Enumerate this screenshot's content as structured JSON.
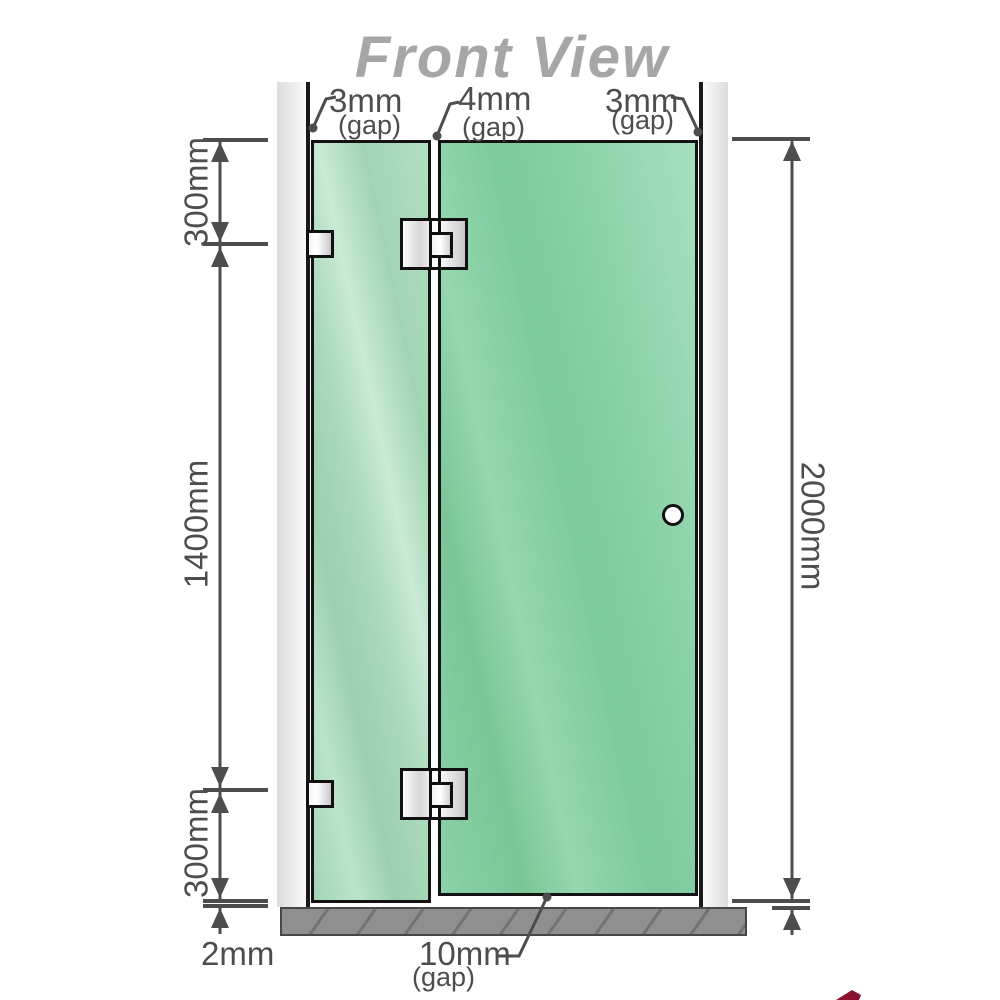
{
  "title": "Front View",
  "labels": {
    "gaps": {
      "left": {
        "value": "3mm",
        "note": "(gap)"
      },
      "middle": {
        "value": "4mm",
        "note": "(gap)"
      },
      "right": {
        "value": "3mm",
        "note": "(gap)"
      },
      "bottom": {
        "value": "10mm",
        "note": "(gap)"
      }
    },
    "dims": {
      "left_top": "300mm",
      "left_middle": "1400mm",
      "left_bottom": "300mm",
      "right_height": "2000mm",
      "floor_clearance": "2mm"
    }
  },
  "components": {
    "fixed_panel": "fixed glass panel",
    "door_panel": "hinged glass door",
    "handle": "door handle",
    "wall_brackets": 2,
    "glass_hinges": 2
  },
  "colors": {
    "glass_fixed": "#a9d8ba",
    "glass_door": "#82cda1",
    "wall": "#e8e8e8",
    "base": "#8f8f8f",
    "dimension": "#4d4d4d",
    "title": "#a6a6a6",
    "watermark": "#8c1130"
  }
}
